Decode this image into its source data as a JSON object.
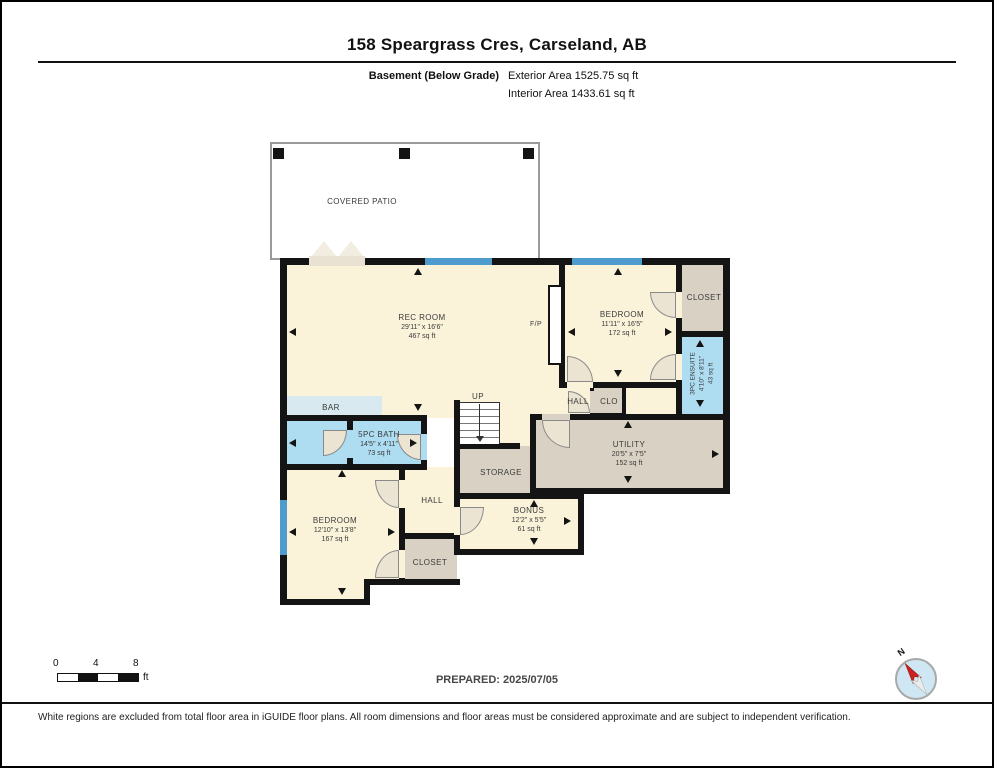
{
  "header": {
    "title": "158 Speargrass Cres, Carseland, AB",
    "floor_label": "Basement (Below Grade)",
    "exterior_area": "Exterior Area 1525.75 sq ft",
    "interior_area": "Interior Area 1433.61 sq ft"
  },
  "plan": {
    "patio": {
      "label": "COVERED PATIO"
    },
    "rooms": {
      "rec_room": {
        "name": "REC ROOM",
        "dims": "29'11\" x 16'6\"",
        "area": "467 sq ft"
      },
      "bedroom_upper": {
        "name": "BEDROOM",
        "dims": "11'11\" x 16'5\"",
        "area": "172 sq ft"
      },
      "closet_upper": {
        "name": "CLOSET"
      },
      "ensuite": {
        "name": "3PC ENSUITE",
        "dims": "4'10\" x 8'11\"",
        "area": "43 sq ft"
      },
      "utility": {
        "name": "UTILITY",
        "dims": "20'5\" x 7'5\"",
        "area": "152 sq ft"
      },
      "storage": {
        "name": "STORAGE"
      },
      "bonus": {
        "name": "BONUS",
        "dims": "12'2\" x 5'5\"",
        "area": "61 sq ft"
      },
      "bath": {
        "name": "5PC BATH",
        "dims": "14'5\" x 4'11\"",
        "area": "73 sq ft"
      },
      "bedroom_lower": {
        "name": "BEDROOM",
        "dims": "12'10\" x 13'8\"",
        "area": "167 sq ft"
      },
      "closet_lower": {
        "name": "CLOSET"
      },
      "hall_upper": {
        "name": "HALL"
      },
      "clo": {
        "name": "CLO"
      },
      "hall_lower": {
        "name": "HALL"
      },
      "bar": {
        "name": "BAR"
      },
      "fireplace": {
        "name": "F/P"
      },
      "stairs": {
        "name": "UP"
      }
    },
    "colors": {
      "wall": "#141414",
      "room_cream": "#faf3da",
      "room_tan": "#d9d1c3",
      "room_blue": "#aedcf1",
      "bar_strip": "#d8e9ef",
      "window": "#4e9ccd"
    }
  },
  "footer": {
    "scale": {
      "tick0": "0",
      "tick4": "4",
      "tick8": "8",
      "unit": "ft"
    },
    "prepared": "PREPARED: 2025/07/05",
    "compass": {
      "north": "N"
    },
    "disclaimer": "White regions are excluded from total floor area in iGUIDE floor plans. All room dimensions and floor areas must be considered approximate and are subject to independent verification."
  }
}
